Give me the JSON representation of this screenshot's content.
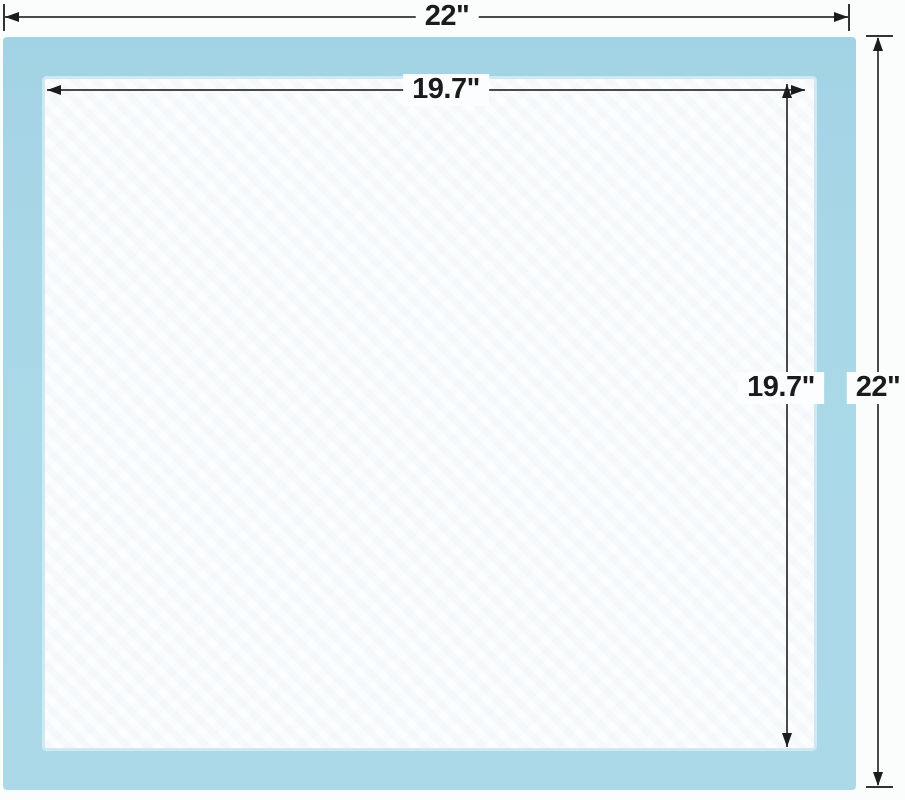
{
  "diagram": {
    "description": "Pad size diagram with outer and inner dimensions",
    "dimensions": {
      "outer_width": "22\"",
      "outer_height": "22\"",
      "inner_width": "19.7\"",
      "inner_height": "19.7\""
    },
    "colors": {
      "pad_border": "#a8d7e7",
      "pad_surface": "#fcfdfe",
      "dimension_line": "#4a4a4a",
      "label_text": "#1b1b1b",
      "background": "#fbfcfc"
    }
  }
}
